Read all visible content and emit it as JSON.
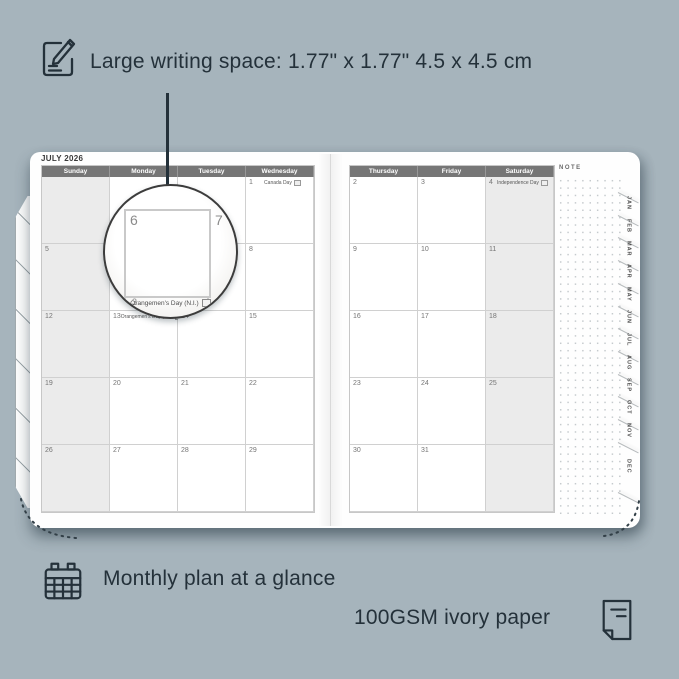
{
  "annotations": {
    "top": {
      "icon": "pencil-note-icon",
      "text": "Large writing space: 1.77\" x 1.77\" 4.5 x 4.5 cm"
    },
    "bottom_left": {
      "icon": "calendar-grid-icon",
      "text": "Monthly plan at a glance"
    },
    "bottom_right": {
      "icon": "paper-icon",
      "text": "100GSM ivory paper"
    }
  },
  "calendar": {
    "title": "JULY 2026",
    "note_label": "NOTE",
    "month_tabs": [
      "JAN",
      "FEB",
      "MAR",
      "APR",
      "MAY",
      "JUN",
      "JUL",
      "AUG",
      "SEP",
      "OCT",
      "NOV",
      "DEC"
    ],
    "left_page": {
      "day_headers": [
        "Sunday",
        "Monday",
        "Tuesday",
        "Wednesday"
      ],
      "shaded_column": "Sunday",
      "weeks": [
        [
          {
            "date": ""
          },
          {
            "date": ""
          },
          {
            "date": ""
          },
          {
            "date": "1",
            "holiday": "Canada Day",
            "holiday_icon": "canada-flag-icon"
          }
        ],
        [
          {
            "date": "5"
          },
          {
            "date": "6"
          },
          {
            "date": "7"
          },
          {
            "date": "8"
          }
        ],
        [
          {
            "date": "12"
          },
          {
            "date": "13",
            "holiday": "Orangemen's Day (N.I.)",
            "holiday_icon": "ni-flag-icon"
          },
          {
            "date": "14"
          },
          {
            "date": "15"
          }
        ],
        [
          {
            "date": "19"
          },
          {
            "date": "20"
          },
          {
            "date": "21"
          },
          {
            "date": "22"
          }
        ],
        [
          {
            "date": "26"
          },
          {
            "date": "27"
          },
          {
            "date": "28"
          },
          {
            "date": "29"
          }
        ]
      ]
    },
    "right_page": {
      "day_headers": [
        "Thursday",
        "Friday",
        "Saturday"
      ],
      "shaded_column": "Saturday",
      "weeks": [
        [
          {
            "date": "2"
          },
          {
            "date": "3"
          },
          {
            "date": "4",
            "holiday": "Independence Day",
            "holiday_icon": "us-flag-icon"
          }
        ],
        [
          {
            "date": "9"
          },
          {
            "date": "10"
          },
          {
            "date": "11"
          }
        ],
        [
          {
            "date": "16"
          },
          {
            "date": "17"
          },
          {
            "date": "18"
          }
        ],
        [
          {
            "date": "23"
          },
          {
            "date": "24"
          },
          {
            "date": "25"
          }
        ],
        [
          {
            "date": "30"
          },
          {
            "date": "31"
          },
          {
            "date": ""
          }
        ]
      ]
    }
  },
  "magnifier": {
    "primary_date": "6",
    "adjacent_date": "7",
    "partial_date": "3",
    "holiday_text": "Orangemen's Day (N.I.)"
  },
  "colors": {
    "background": "#a6b4bc",
    "ink": "#24313a",
    "page": "#fefefe",
    "header_bar": "#767676",
    "weekend_shade": "#ebebeb",
    "grid_line": "#d0d0d0"
  }
}
